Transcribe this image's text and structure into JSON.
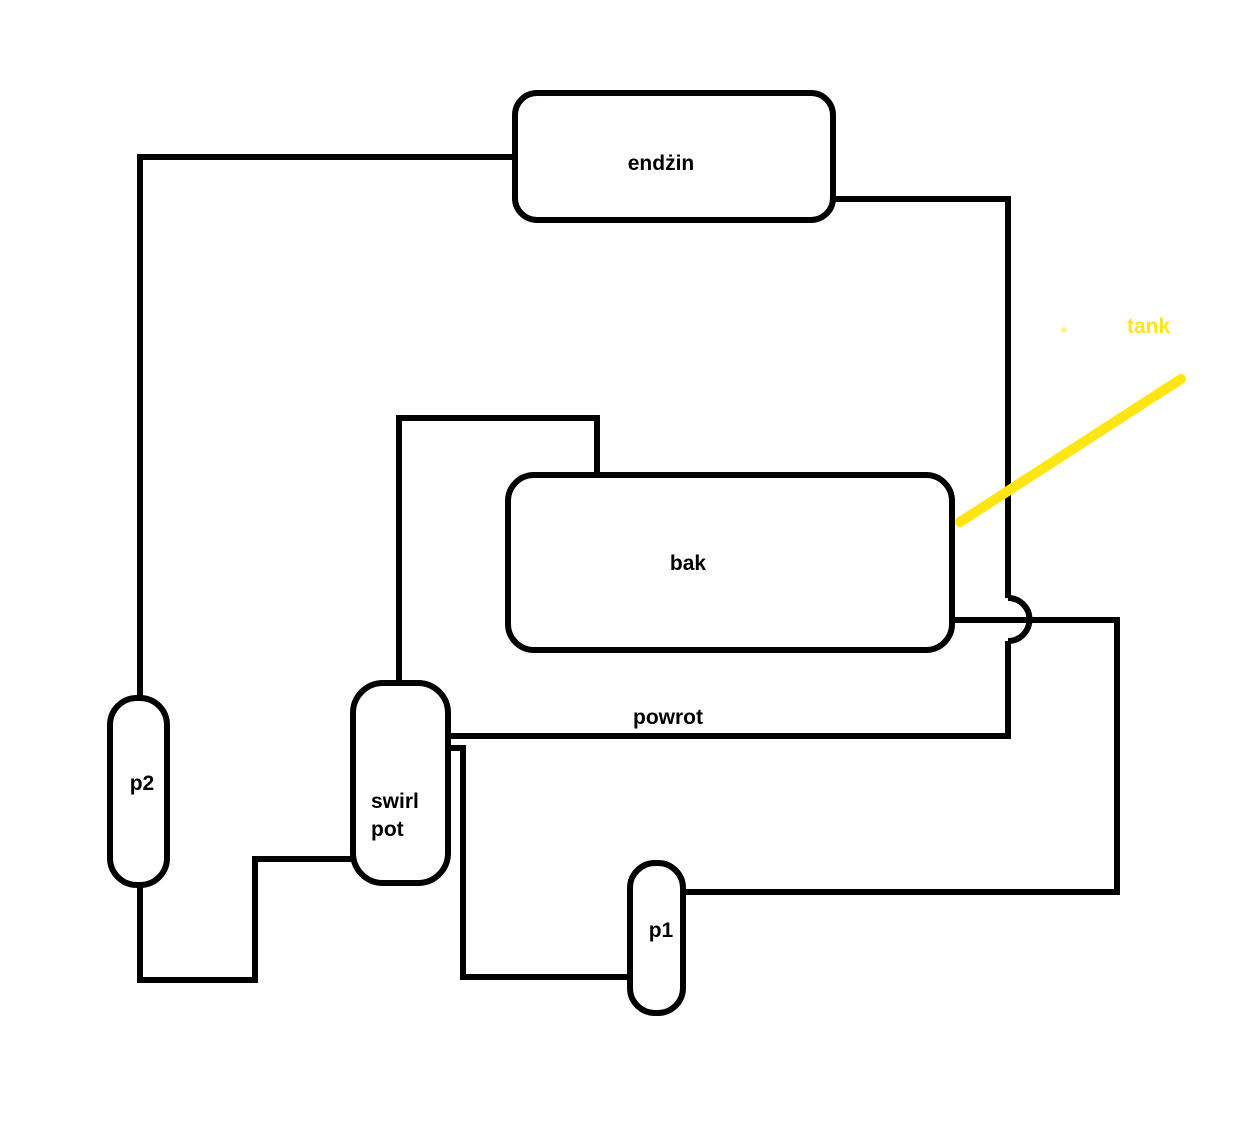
{
  "nodes": {
    "engine": {
      "label": "endżin"
    },
    "fuel_tank": {
      "label": "bak"
    },
    "swirl_pot": {
      "label_line1": "swirl",
      "label_line2": "pot"
    },
    "pump1": {
      "label": "p1"
    },
    "pump2": {
      "label": "p2"
    }
  },
  "annotations": {
    "return_line_label": "powrot",
    "tank_callout_label": "tank"
  },
  "colors": {
    "line": "#000000",
    "text": "#000000",
    "highlight": "#ffe512",
    "background": "#ffffff"
  }
}
